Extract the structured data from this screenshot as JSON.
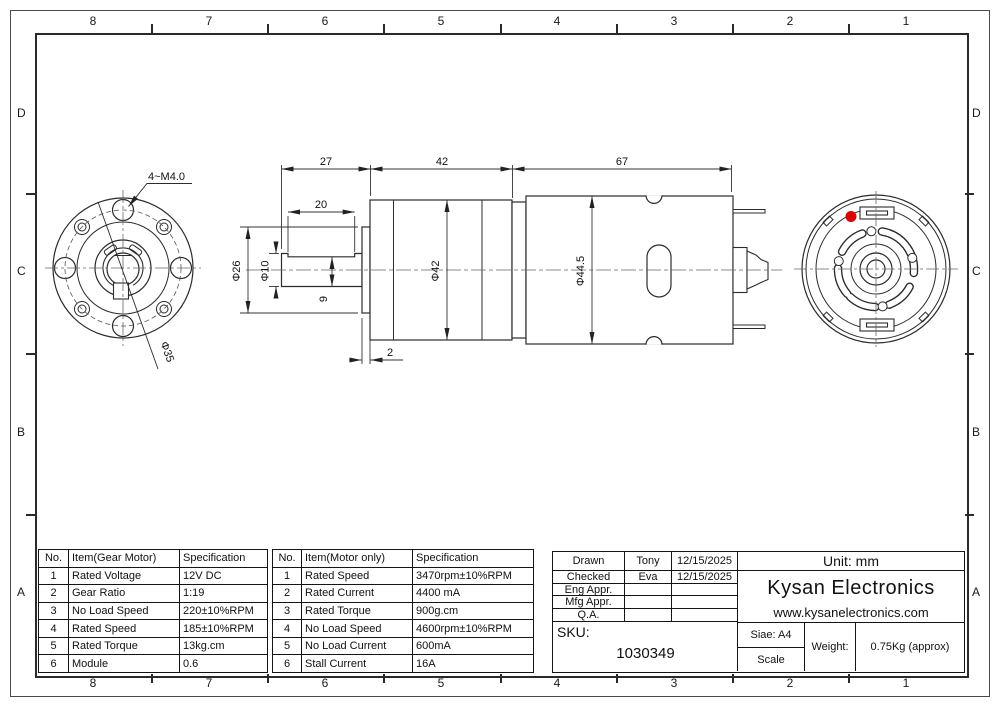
{
  "border": {
    "top": [
      "8",
      "7",
      "6",
      "5",
      "4",
      "3",
      "2",
      "1"
    ],
    "bottom": [
      "8",
      "7",
      "6",
      "5",
      "4",
      "3",
      "2",
      "1"
    ],
    "left": [
      "D",
      "C",
      "B",
      "A"
    ],
    "right": [
      "D",
      "C",
      "B",
      "A"
    ]
  },
  "dims": {
    "shaft_length": "27",
    "gear_length": "42",
    "motor_length": "67",
    "flat_length": "20",
    "pilot_dia": "Φ26",
    "shaft_dia": "Φ10",
    "flat_drop": "9",
    "gear_dia": "Φ42",
    "motor_dia": "Φ44.5",
    "plate_thickness": "2",
    "bolt_spec": "4~M4.0",
    "bolt_circle_dia": "Φ35"
  },
  "colors": {
    "marker_red": "#e10000",
    "line": "#2b2b2b"
  },
  "tables": {
    "gear_motor": {
      "headers": [
        "No.",
        "Item(Gear Motor)",
        "Specification"
      ],
      "rows": [
        [
          "1",
          "Rated Voltage",
          "12V DC"
        ],
        [
          "2",
          "Gear Ratio",
          "1:19"
        ],
        [
          "3",
          "No Load Speed",
          "220±10%RPM"
        ],
        [
          "4",
          "Rated Speed",
          "185±10%RPM"
        ],
        [
          "5",
          "Rated Torque",
          "13kg.cm"
        ],
        [
          "6",
          "Module",
          "0.6"
        ]
      ]
    },
    "motor_only": {
      "headers": [
        "No.",
        "Item(Motor only)",
        "Specification"
      ],
      "rows": [
        [
          "1",
          "Rated Speed",
          "3470rpm±10%RPM"
        ],
        [
          "2",
          "Rated Current",
          "4400 mA"
        ],
        [
          "3",
          "Rated Torque",
          "900g.cm"
        ],
        [
          "4",
          "No Load Speed",
          "4600rpm±10%RPM"
        ],
        [
          "5",
          "No Load Current",
          "600mA"
        ],
        [
          "6",
          "Stall Current",
          "16A"
        ]
      ]
    }
  },
  "title_block": {
    "approvals": [
      {
        "role": "Drawn",
        "name": "Tony",
        "date": "12/15/2025"
      },
      {
        "role": "Checked",
        "name": "Eva",
        "date": "12/15/2025"
      },
      {
        "role": "Eng Appr.",
        "name": "",
        "date": ""
      },
      {
        "role": "Mfg Appr.",
        "name": "",
        "date": ""
      },
      {
        "role": "Q.A.",
        "name": "",
        "date": ""
      }
    ],
    "unit": "Unit: mm",
    "company": "Kysan Electronics",
    "website": "www.kysanelectronics.com",
    "sku_label": "SKU:",
    "sku_number": "1030349",
    "size": "Siae: A4",
    "scale_label": "Scale",
    "weight_label": "Weight:",
    "weight_value": "0.75Kg (approx)"
  }
}
